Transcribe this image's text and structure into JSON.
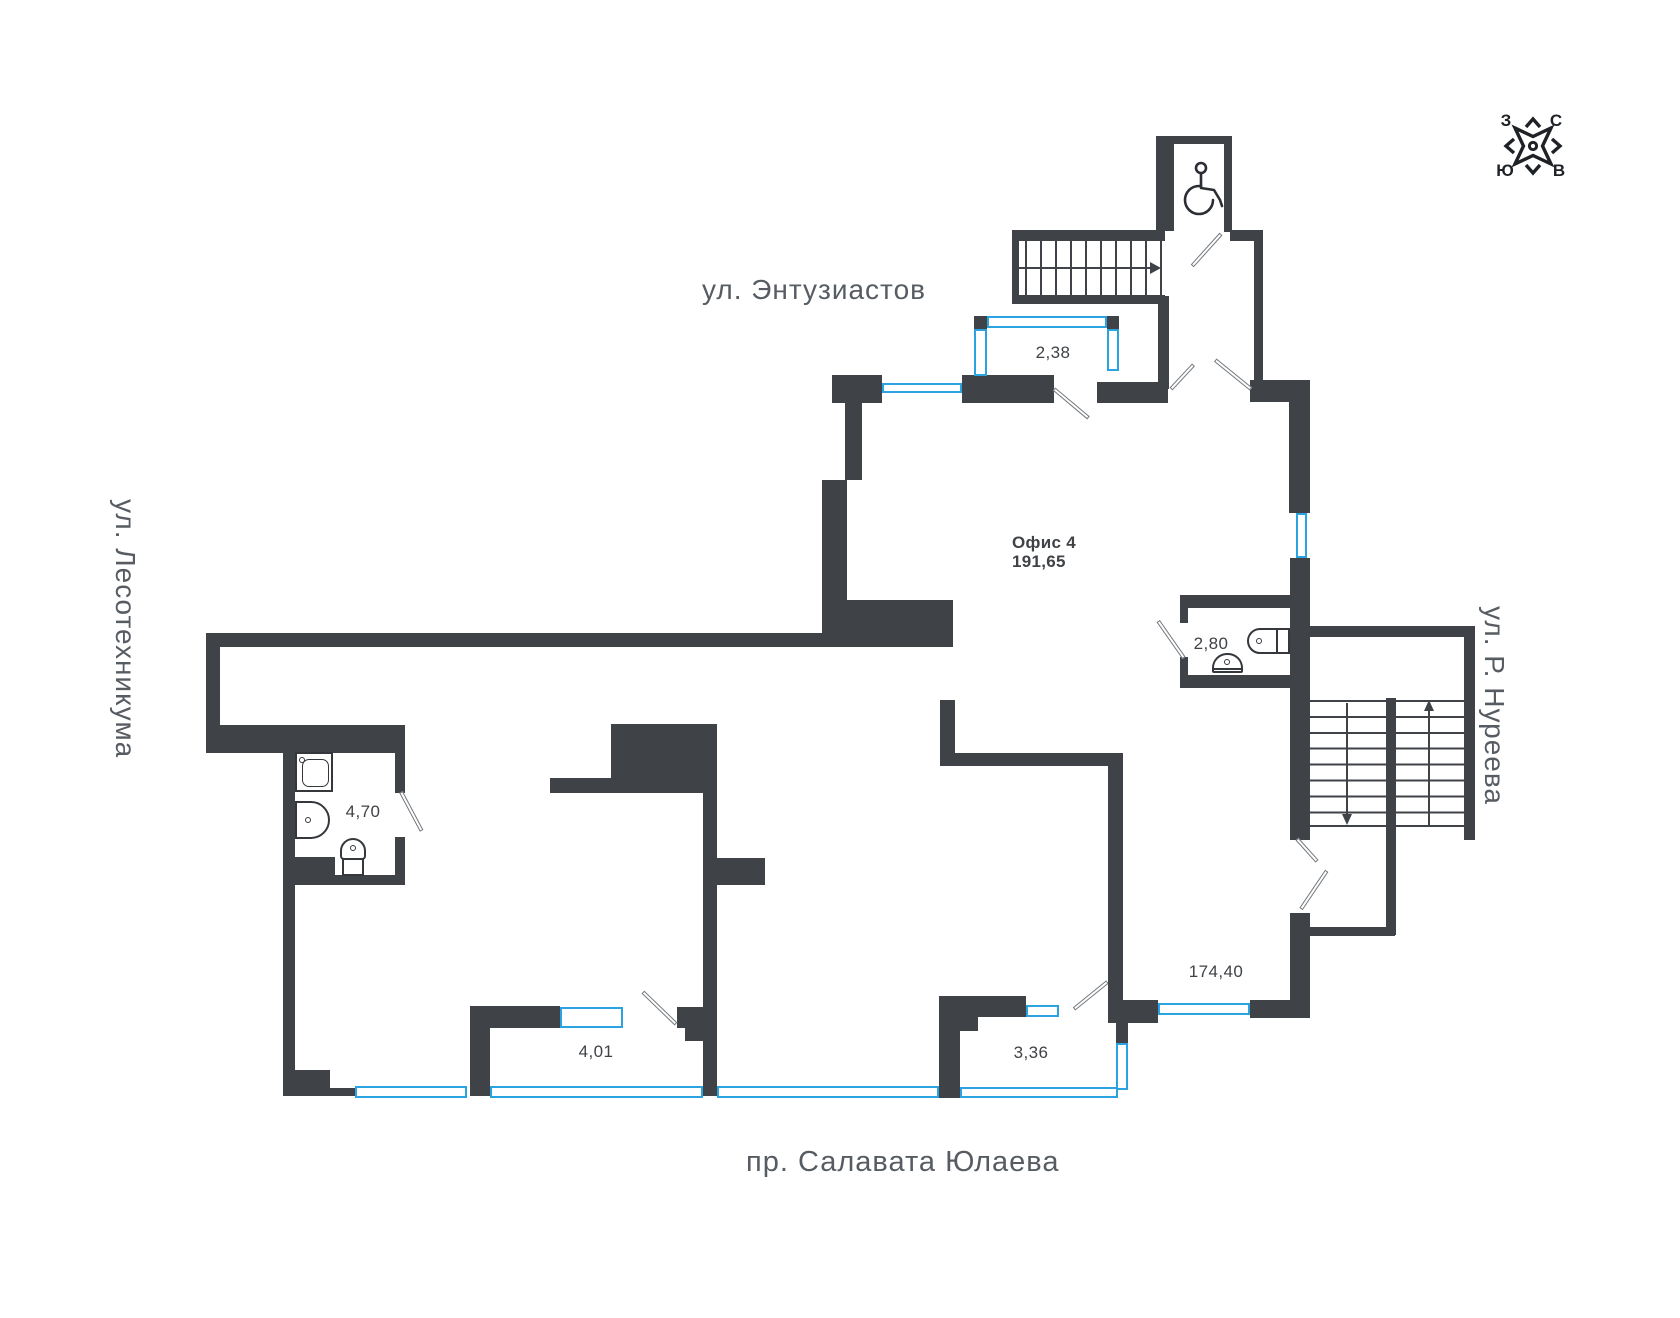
{
  "streets": {
    "top": "ул. Энтузиастов",
    "left": "ул. Лесотехникума",
    "right": "ул. Р. Нуреева",
    "bottom": "пр. Салавата Юлаева"
  },
  "office": {
    "name": "Офис 4",
    "area": "191,65"
  },
  "areas": {
    "balcony": "2,38",
    "wc_top": "2,80",
    "wc_left": "4,70",
    "room_left": "4,01",
    "room_right": "3,36",
    "main": "174,40"
  },
  "compass": {
    "top_left": "З",
    "top_right": "С",
    "bottom_left": "Ю",
    "bottom_right": "В"
  },
  "colors": {
    "wall": "#3f4246",
    "window": "#2ba3e0",
    "street_label": "#575c63",
    "area_label": "#3f4246"
  }
}
